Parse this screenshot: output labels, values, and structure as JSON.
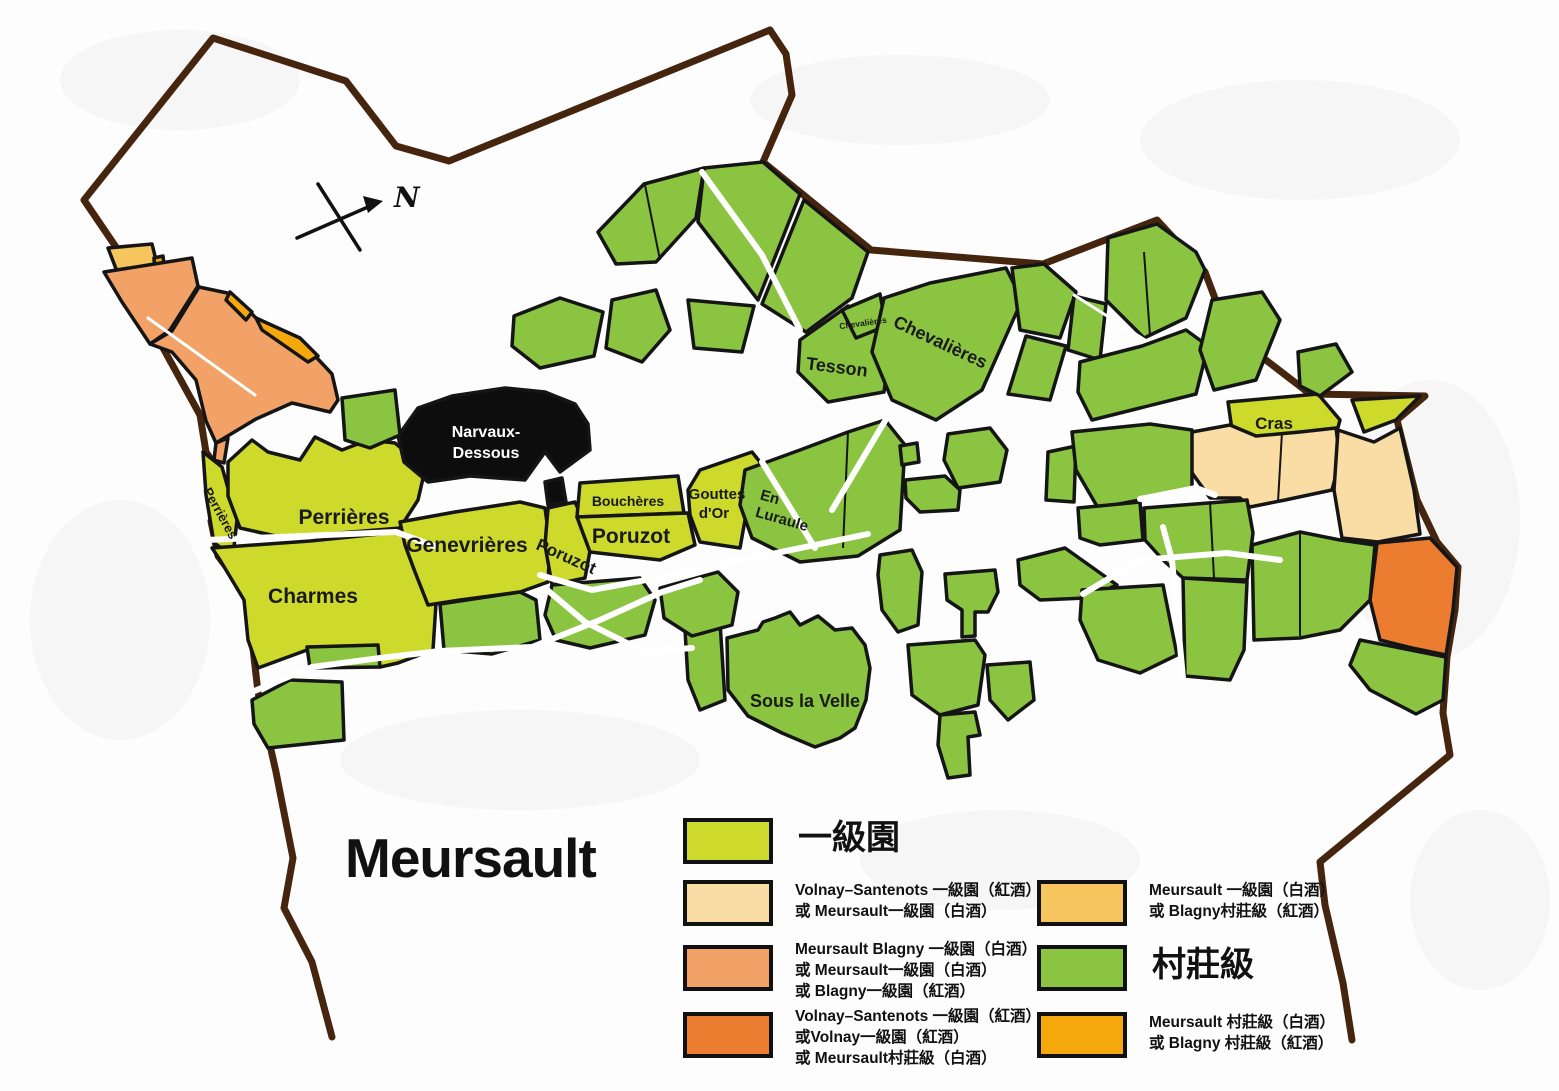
{
  "title": "Meursault",
  "compass": {
    "label": "N"
  },
  "vineyard_labels": {
    "perrieres_small": "Perrières",
    "perrieres": "Perrières",
    "charmes": "Charmes",
    "genevrieres": "Genevrières",
    "poruzot_small": "Poruzot",
    "poruzot": "Poruzot",
    "boucheres": "Bouchères",
    "gouttes_dor_line1": "Gouttes",
    "gouttes_dor_line2": "d'Or",
    "en_luraule_line1": "En",
    "en_luraule_line2": "Luraule",
    "narvaux_line1": "Narvaux-",
    "narvaux_line2": "Dessous",
    "tesson": "Tesson",
    "chevalieres_small": "Chevalières",
    "chevalieres": "Chevalières",
    "cras": "Cras",
    "sous_la_velle": "Sous la Velle"
  },
  "legend": {
    "left": [
      {
        "label": "一級園"
      },
      {
        "line1": "Volnay–Santenots 一級園（紅酒）",
        "line2": "或 Meursault一級園（白酒）"
      },
      {
        "line1": "Meursault Blagny 一級園（白酒）",
        "line2": "或 Meursault一級園（白酒）",
        "line3": "或 Blagny一級園（紅酒）"
      },
      {
        "line1": "Volnay–Santenots 一級園（紅酒）",
        "line2": "或Volnay一級園（紅酒）",
        "line3": "或 Meursault村莊級（白酒）"
      }
    ],
    "right": [
      {
        "line1": "Meursault 一級園（白酒）",
        "line2": "或 Blagny村莊級（紅酒）"
      },
      {
        "label": "村莊級"
      },
      {
        "line1": "Meursault 村莊級（白酒）",
        "line2": "或 Blagny 村莊級（紅酒）"
      }
    ]
  },
  "colors": {
    "premier_cru": "#cdd92b",
    "village": "#8ac441",
    "volnay_santenots_white": "#fadda4",
    "blagny_premier_cru": "#f2a266",
    "volnay_santenots_red": "#ec7d30",
    "meursault_premier_cru_white": "#f6c55e",
    "meursault_village_white": "#f5a80c",
    "monopole_black": "#0d0d0d",
    "commune_boundary": "#46250f"
  }
}
